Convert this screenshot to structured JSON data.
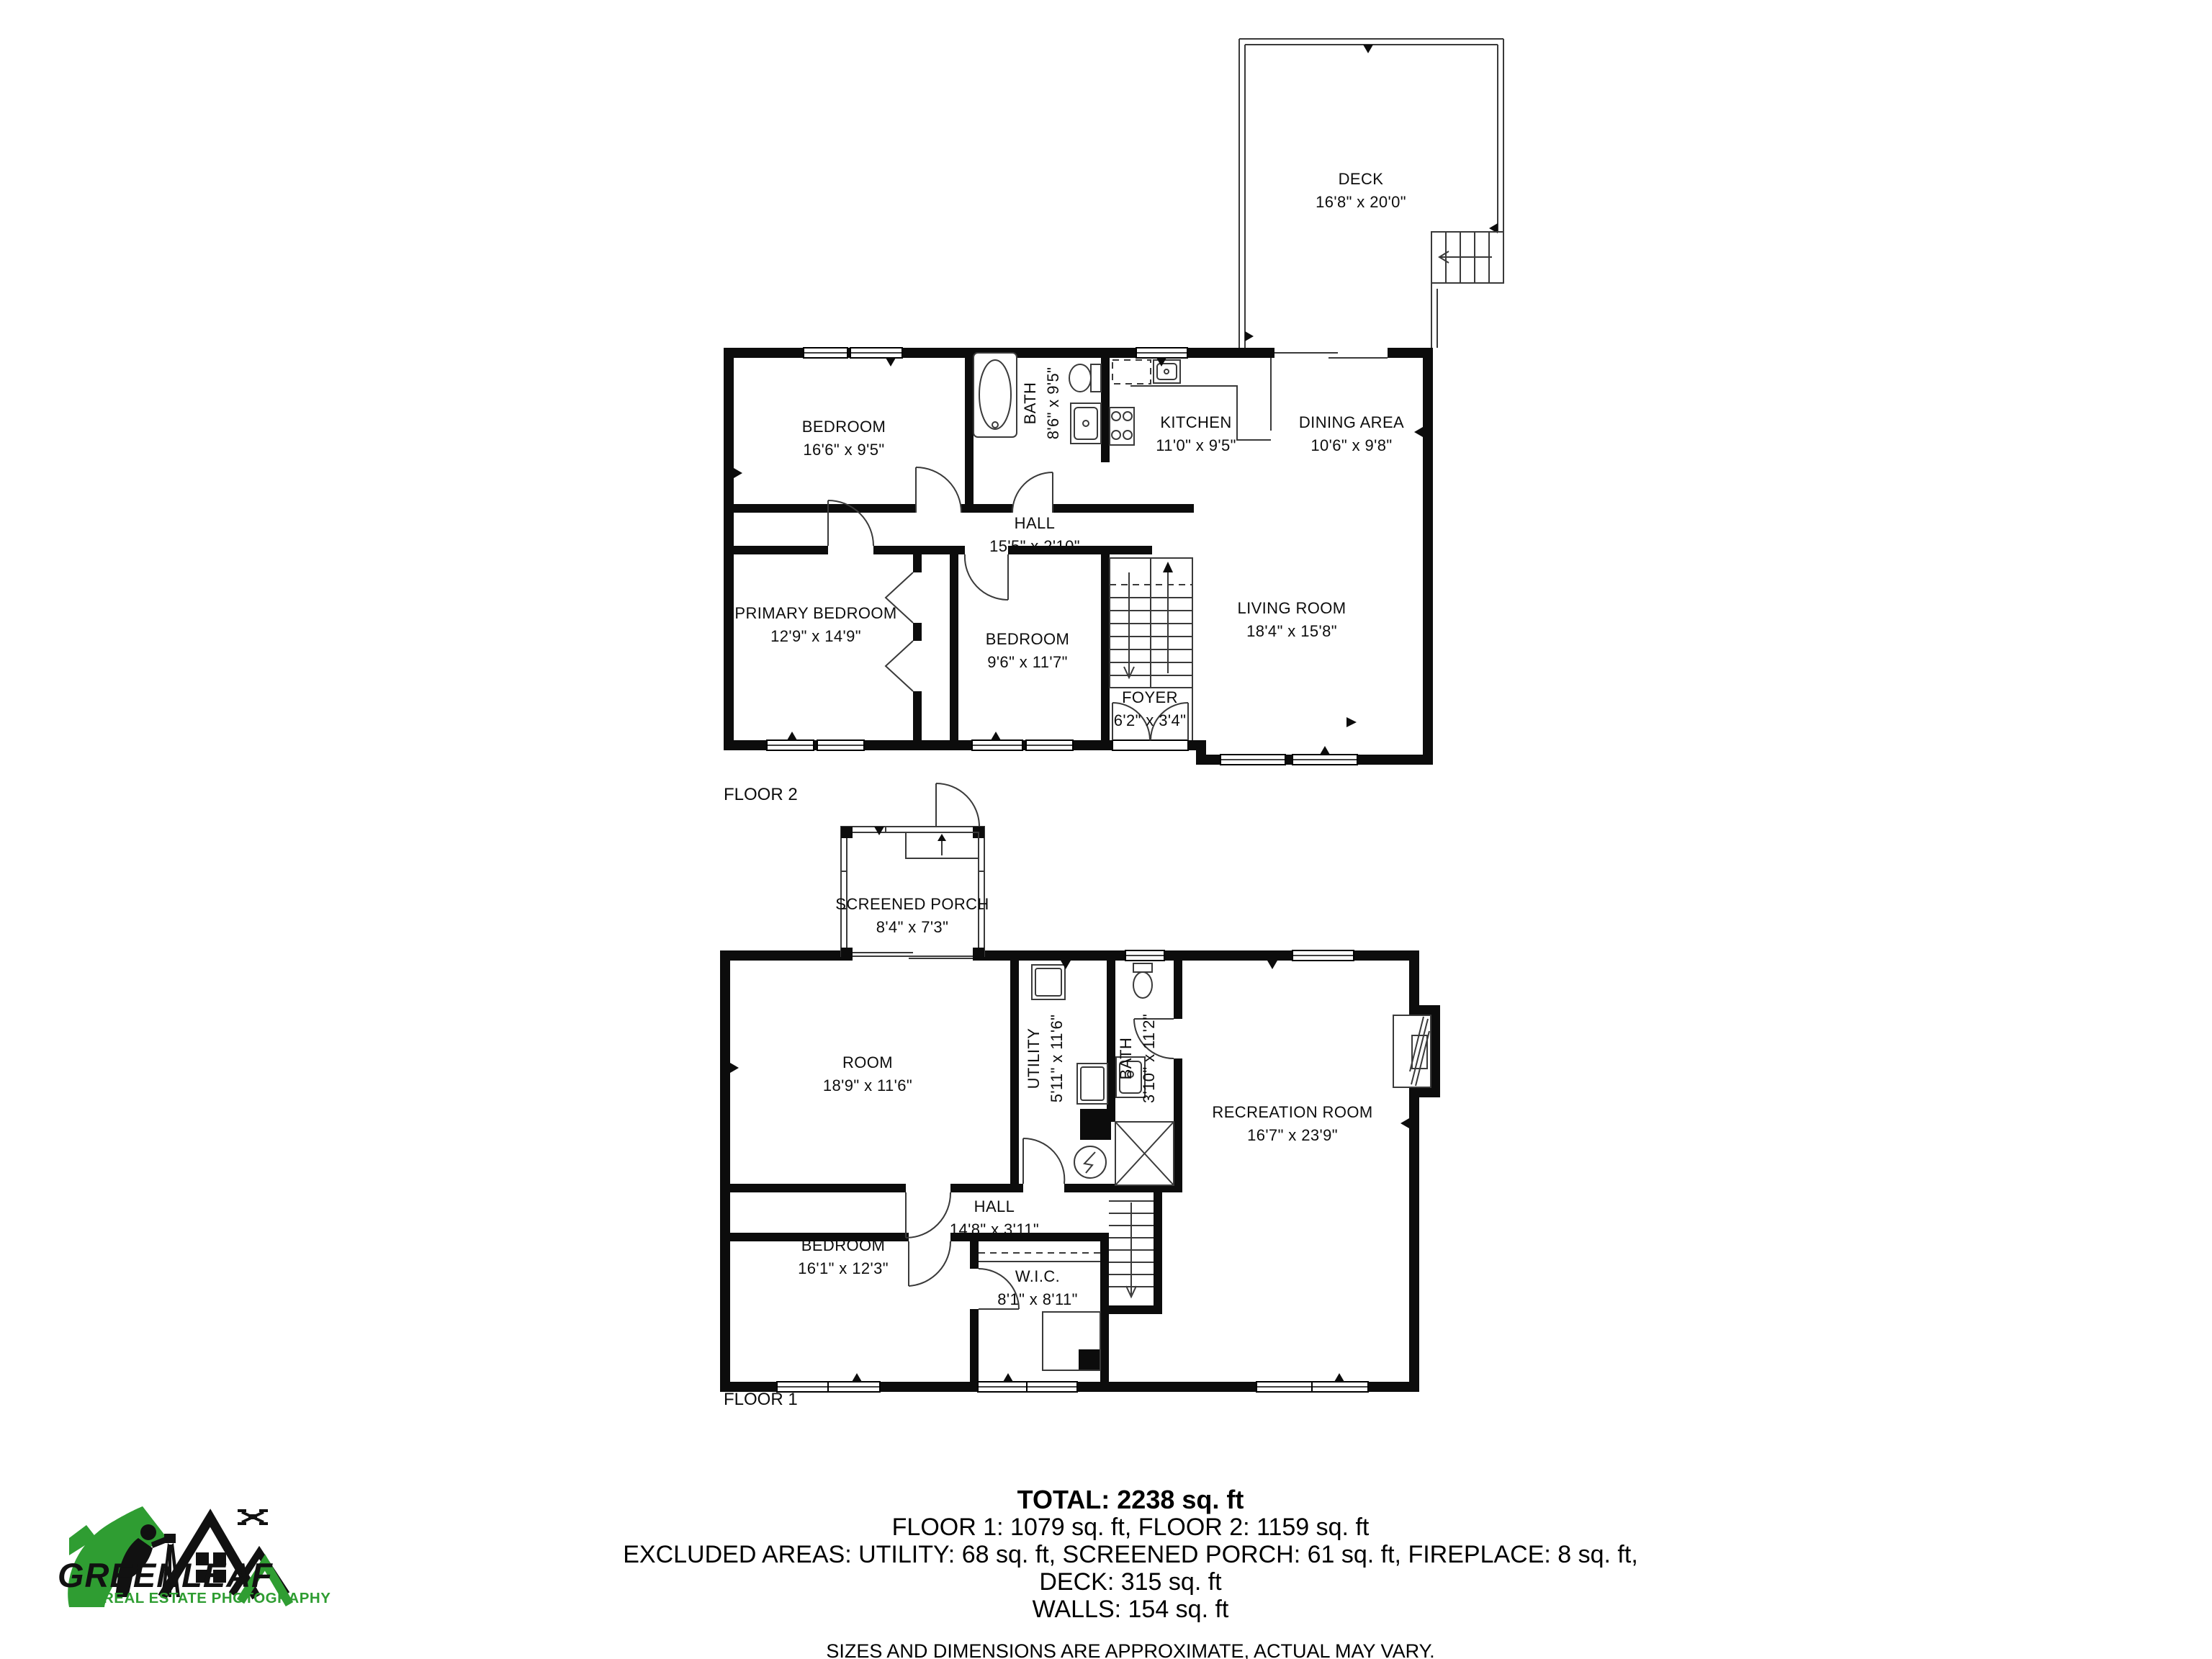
{
  "branding": {
    "logo_title": "GREENLEAF",
    "logo_subtitle": "REAL ESTATE PHOTOGRAPHY",
    "green": "#2f9d32",
    "black": "#111111"
  },
  "floor2": {
    "floor_label": "FLOOR 2",
    "deck": {
      "name": "DECK",
      "dims": "16'8\" x 20'0\""
    },
    "rooms": {
      "bedroom1": {
        "name": "BEDROOM",
        "dims": "16'6\" x 9'5\""
      },
      "bath": {
        "name": "BATH",
        "dims": "8'6\" x 9'5\""
      },
      "kitchen": {
        "name": "KITCHEN",
        "dims": "11'0\" x 9'5\""
      },
      "dining": {
        "name": "DINING AREA",
        "dims": "10'6\" x 9'8\""
      },
      "hall": {
        "name": "HALL",
        "dims": "15'5\" x 2'10\""
      },
      "primary": {
        "name": "PRIMARY BEDROOM",
        "dims": "12'9\" x 14'9\""
      },
      "bedroom2": {
        "name": "BEDROOM",
        "dims": "9'6\" x 11'7\""
      },
      "living": {
        "name": "LIVING ROOM",
        "dims": "18'4\" x 15'8\""
      },
      "foyer": {
        "name": "FOYER",
        "dims": "6'2\" x 3'4\""
      }
    }
  },
  "floor1": {
    "floor_label": "FLOOR 1",
    "rooms": {
      "porch": {
        "name": "SCREENED PORCH",
        "dims": "8'4\" x 7'3\""
      },
      "room": {
        "name": "ROOM",
        "dims": "18'9\" x 11'6\""
      },
      "utility": {
        "name": "UTILITY",
        "dims": "5'11\" x 11'6\""
      },
      "bath": {
        "name": "BATH",
        "dims": "3'10\" x 11'2\""
      },
      "recreation": {
        "name": "RECREATION ROOM",
        "dims": "16'7\" x 23'9\""
      },
      "hall": {
        "name": "HALL",
        "dims": "14'8\" x 3'11\""
      },
      "bedroom": {
        "name": "BEDROOM",
        "dims": "16'1\" x 12'3\""
      },
      "wic": {
        "name": "W.I.C.",
        "dims": "8'1\" x 8'11\""
      }
    }
  },
  "summary": {
    "total": "TOTAL: 2238 sq. ft",
    "floors": "FLOOR 1: 1079 sq. ft, FLOOR 2: 1159 sq. ft",
    "excluded": "EXCLUDED AREAS: UTILITY: 68 sq. ft, SCREENED PORCH: 61 sq. ft, FIREPLACE: 8 sq. ft,",
    "deck": "DECK: 315 sq. ft",
    "walls": "WALLS: 154 sq. ft",
    "disclaimer": "SIZES AND DIMENSIONS ARE APPROXIMATE, ACTUAL MAY VARY."
  }
}
